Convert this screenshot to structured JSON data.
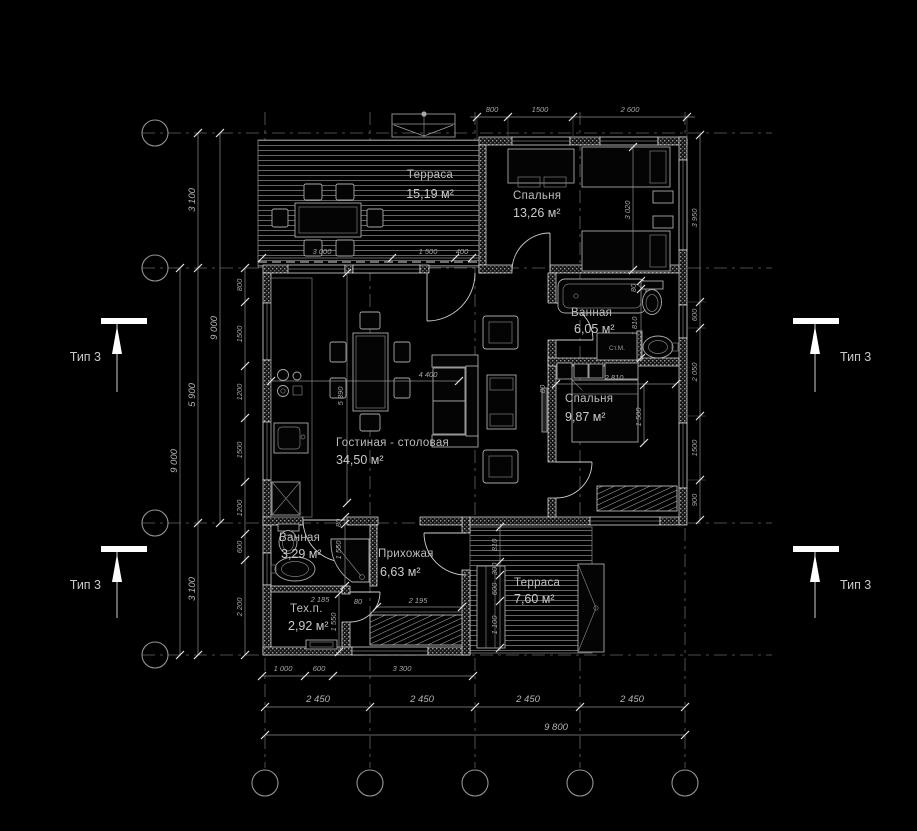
{
  "rooms": {
    "terrace_top": {
      "name": "Терраса",
      "area": "15,19 м²"
    },
    "bedroom1": {
      "name": "Спальня",
      "area": "13,26 м²"
    },
    "bathroom1": {
      "name": "Ванная",
      "area": "6,05 м²"
    },
    "bedroom2": {
      "name": "Спальня",
      "area": "9,87 м²"
    },
    "living": {
      "name": "Гостиная - столовая",
      "area": "34,50 м²"
    },
    "bathroom2": {
      "name": "Ванная",
      "area": "3,29 м²"
    },
    "hallway": {
      "name": "Прихожая",
      "area": "6,63 м²"
    },
    "tech": {
      "name": "Тех.п.",
      "area": "2,92 м²"
    },
    "terrace_bottom": {
      "name": "Терраса",
      "area": "7,60 м²"
    },
    "washer": "Ст.М."
  },
  "section_markers": {
    "label": "Тип 3"
  },
  "dims": {
    "top": [
      "800",
      "1500",
      "2 600"
    ],
    "left_outer_a": "9 000",
    "left_outer_b": "9 000",
    "left_mid": [
      "3 100",
      "5 900",
      "3 100"
    ],
    "left_inner": [
      "800",
      "1500",
      "1200",
      "1500",
      "1200",
      "600",
      "2 200"
    ],
    "right": [
      "3 950",
      "600",
      "2 050",
      "1500",
      "900"
    ],
    "bottom_house": [
      "1 000",
      "600",
      "3 300"
    ],
    "bottom_axes": [
      "2 450",
      "2 450",
      "2 450",
      "2 450"
    ],
    "bottom_total": "9 800",
    "terrace_top": [
      "3 000",
      "1 500",
      "400"
    ],
    "living_w": "4 400",
    "living_h": "5 390",
    "bedroom1_h": "3 020",
    "bedroom2_w": "2 810",
    "bedroom2_bed": "1 500",
    "bedroom2_gap": "80",
    "bathroom1_h": "1 810",
    "bathroom1_gap": "80",
    "annex_a": "80",
    "annex_b": "1 550",
    "annex_c": "1 550",
    "annex_d": "80",
    "annex_e": "2 185",
    "annex_f": "2 195",
    "terrace_bottom": [
      "810",
      "300",
      "600",
      "1 100"
    ]
  },
  "colors": {
    "background": "#000000",
    "line": "#e6e6e6",
    "dim_text": "#a6a6a6"
  }
}
